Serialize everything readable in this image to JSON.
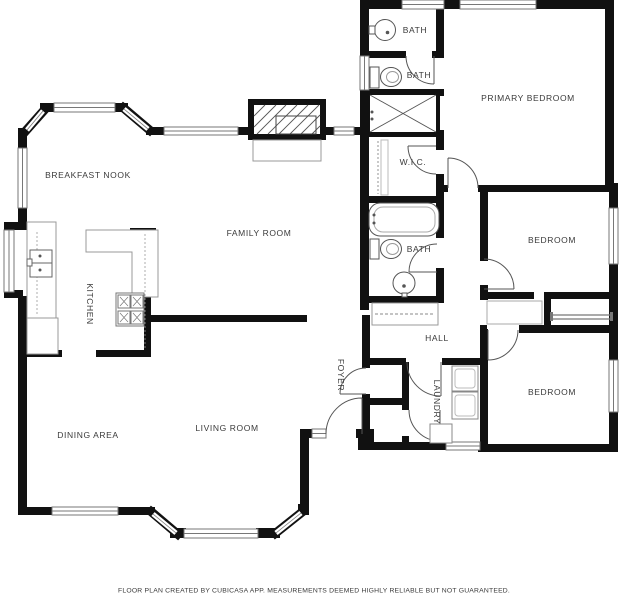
{
  "plan": {
    "title": "Floor plan",
    "rooms": [
      {
        "id": "breakfast-nook",
        "label": "BREAKFAST NOOK"
      },
      {
        "id": "family-room",
        "label": "FAMILY ROOM"
      },
      {
        "id": "kitchen",
        "label": "KITCHEN"
      },
      {
        "id": "dining-area",
        "label": "DINING AREA"
      },
      {
        "id": "living-room",
        "label": "LIVING ROOM"
      },
      {
        "id": "primary-bedroom",
        "label": "PRIMARY BEDROOM"
      },
      {
        "id": "bedroom-middle",
        "label": "BEDROOM"
      },
      {
        "id": "bedroom-bottom",
        "label": "BEDROOM"
      },
      {
        "id": "bath-top",
        "label": "BATH"
      },
      {
        "id": "bath-upper",
        "label": "BATH"
      },
      {
        "id": "bath-hall",
        "label": "BATH"
      },
      {
        "id": "walk-in-closet",
        "label": "W.I.C."
      },
      {
        "id": "hall",
        "label": "HALL"
      },
      {
        "id": "foyer",
        "label": "FOYER"
      },
      {
        "id": "laundry",
        "label": "LAUNDRY"
      }
    ],
    "fixtures": [
      "fireplace",
      "kitchen-sink",
      "stove",
      "refrigerator-counter",
      "bathtub",
      "shower",
      "toilet",
      "pedestal-sink",
      "washer",
      "dryer",
      "laundry-sink",
      "closet-rod",
      "sliding-closet-doors"
    ],
    "colors": {
      "wall": "#111111",
      "fixture_line": "#666666",
      "light_line": "#999999",
      "label_text": "#3a3a3a",
      "background": "#ffffff"
    },
    "footer": "FLOOR PLAN CREATED BY CUBICASA APP. MEASUREMENTS DEEMED HIGHLY RELIABLE BUT NOT GUARANTEED."
  }
}
